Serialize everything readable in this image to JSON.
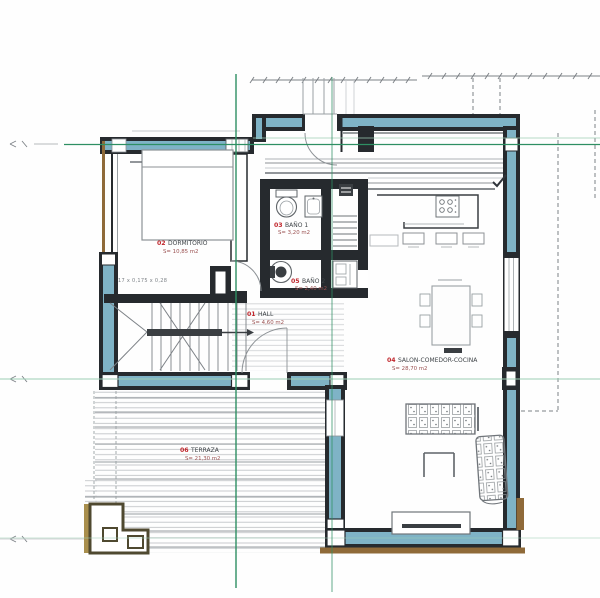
{
  "drawing": {
    "type": "floor-plan",
    "rooms": {
      "hall": {
        "index": "01",
        "name": "HALL",
        "area": "S= 4,60 m2"
      },
      "bedroom": {
        "index": "02",
        "name": "DORMITORIO",
        "area": "S= 10,85 m2"
      },
      "bath1": {
        "index": "03",
        "name": "BAÑO 1",
        "area": "S= 3,20 m2"
      },
      "living": {
        "index": "04",
        "name": "SALON-COMEDOR-COCINA",
        "area": "S= 28,70 m2"
      },
      "bath2": {
        "index": "05",
        "name": "BAÑO 2",
        "area": "S= 2,40 m2"
      },
      "terrace": {
        "index": "06",
        "name": "TERRAZA",
        "area": "S= 21,30 m2"
      }
    },
    "annotations": {
      "stair_note": "17 x 0,175 x 0,28"
    }
  },
  "colors": {
    "wall_dark": "#262a2e",
    "wall_teal": "#7fb3c6",
    "wall_teal_light": "#a9cfdc",
    "axis_green": "#2e8f63",
    "axis_green_faint": "#9ccdb4",
    "label_red": "#c0262c",
    "label_text": "#3f4448",
    "label_area": "#9a5050",
    "wood_dark": "#4f4930",
    "wood_tan": "#a98f4d",
    "wood_band": "#8f6a39",
    "hatch": "#c2c5c8",
    "hatch_dark": "#989da1",
    "dim": "#7c8186",
    "furn": "#70757a",
    "furn_light": "#9aa0a4"
  }
}
